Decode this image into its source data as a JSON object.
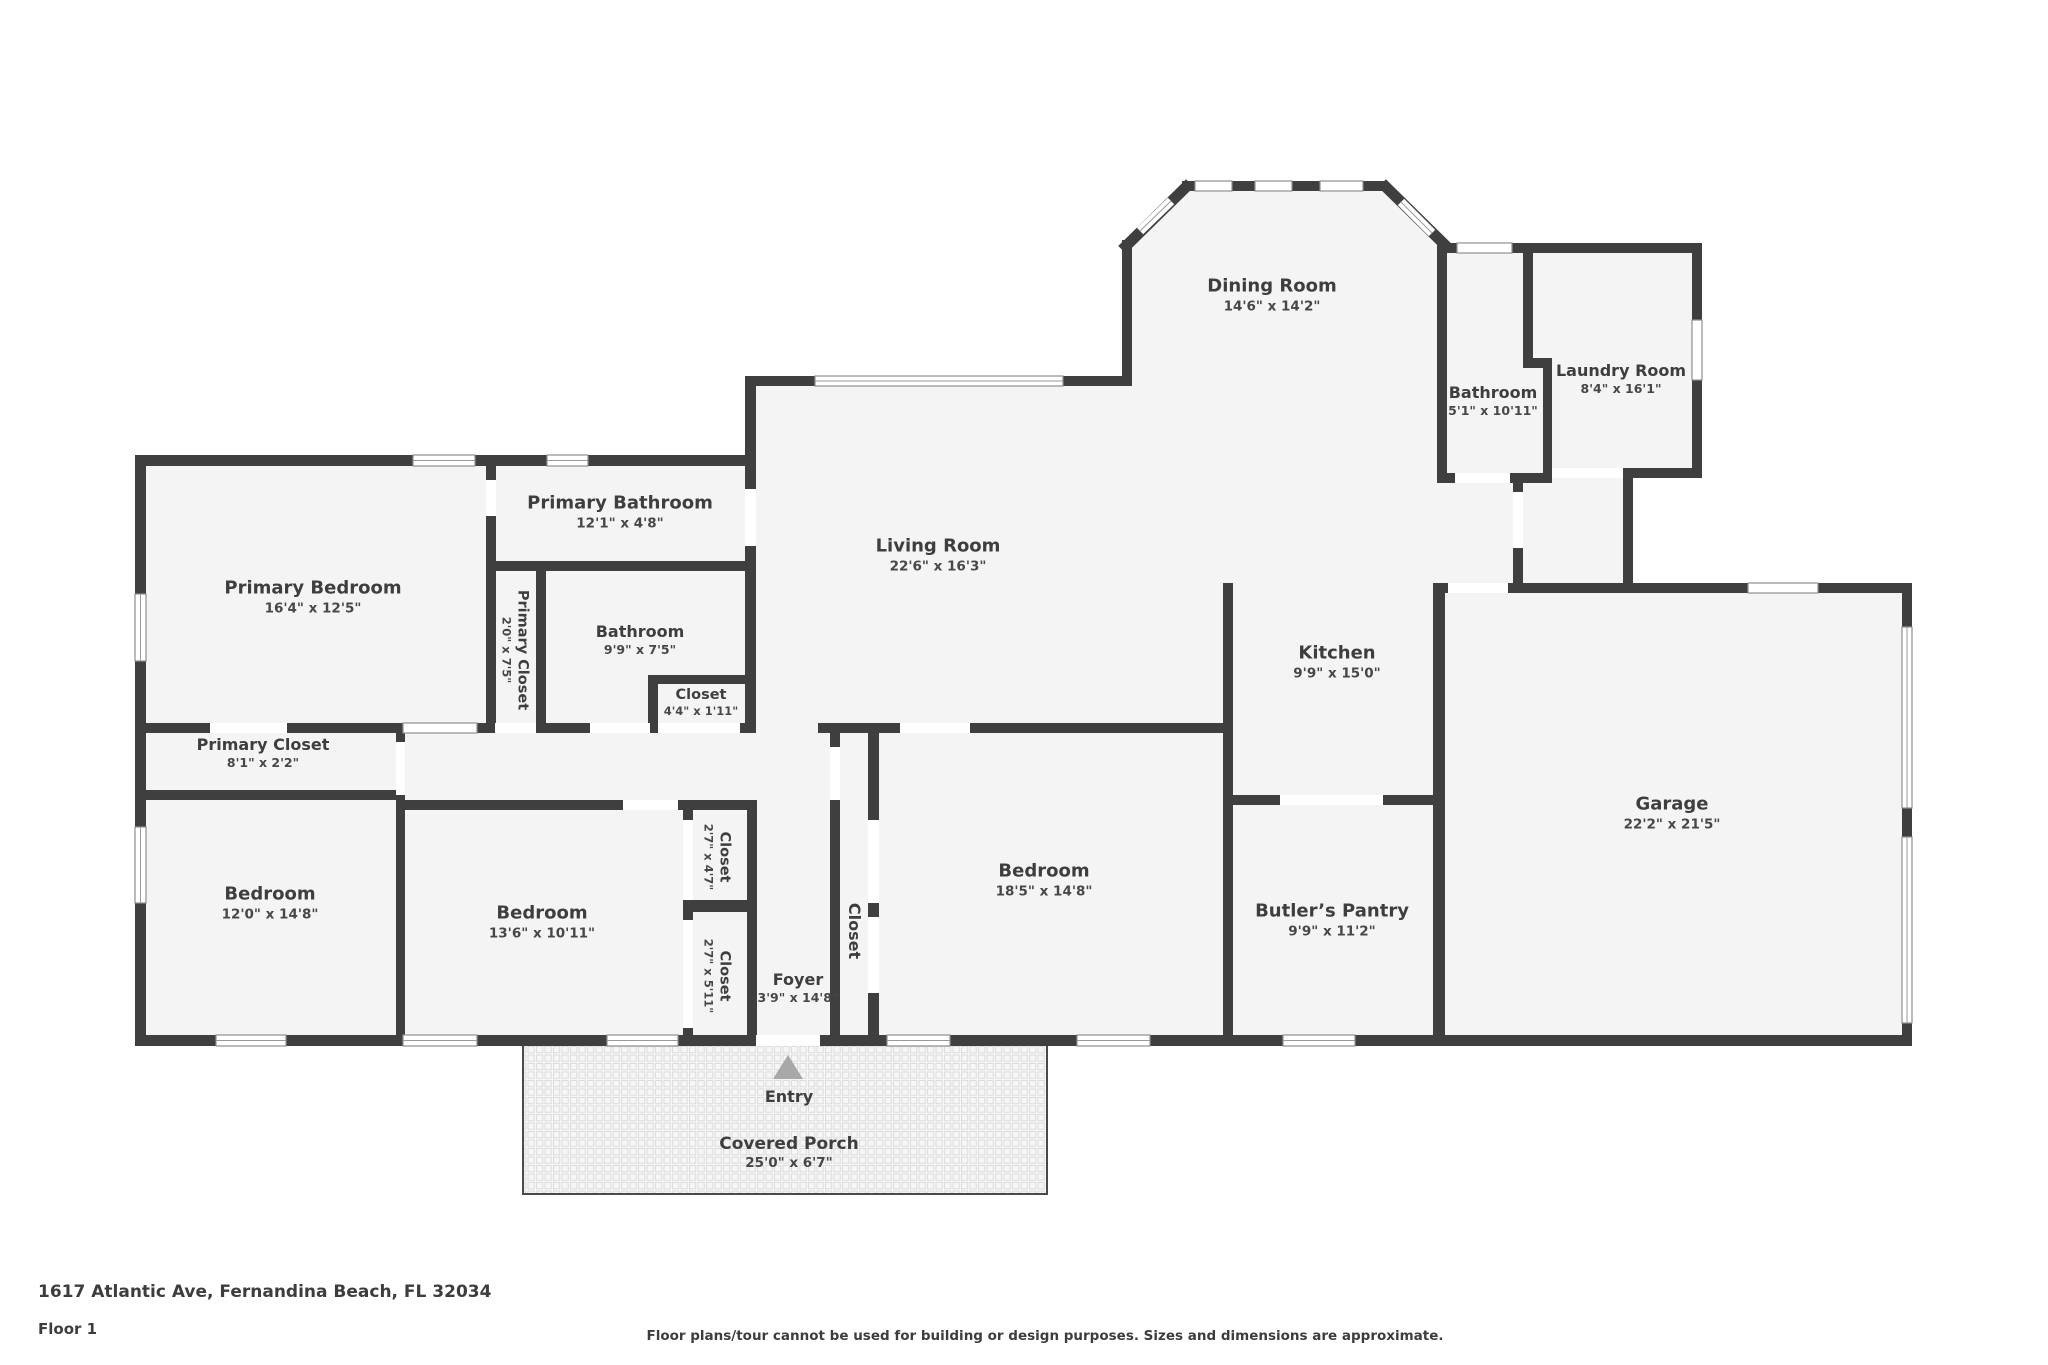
{
  "meta": {
    "address": "1617 Atlantic Ave, Fernandina Beach, FL 32034",
    "floor_label": "Floor 1",
    "disclaimer": "Floor plans/tour cannot be used for building or design purposes. Sizes and dimensions are approximate."
  },
  "colors": {
    "wall": "#3f3f3f",
    "room_fill": "#f4f4f4",
    "window_frame": "#8f8f8f",
    "porch_grid": "#dcdcdc",
    "entry_arrow": "#a8a8a8",
    "text": "#3e3e3e"
  },
  "rooms": {
    "dining": {
      "name": "Dining Room",
      "dims": "14'6\" x 14'2\""
    },
    "living": {
      "name": "Living Room",
      "dims": "22'6\" x 16'3\""
    },
    "kitchen": {
      "name": "Kitchen",
      "dims": "9'9\" x 15'0\""
    },
    "garage": {
      "name": "Garage",
      "dims": "22'2\" x 21'5\""
    },
    "bathroom_top": {
      "name": "Bathroom",
      "dims": "5'1\" x 10'11\""
    },
    "laundry": {
      "name": "Laundry Room",
      "dims": "8'4\" x 16'1\""
    },
    "primary_bedroom": {
      "name": "Primary Bedroom",
      "dims": "16'4\" x 12'5\""
    },
    "primary_bathroom": {
      "name": "Primary Bathroom",
      "dims": "12'1\" x 4'8\""
    },
    "primary_closet_tall": {
      "name": "Primary Closet",
      "dims": "2'0\" x 7'5\""
    },
    "bathroom_mid": {
      "name": "Bathroom",
      "dims": "9'9\" x 7'5\""
    },
    "closet_small": {
      "name": "Closet",
      "dims": "4'4\" x 1'11\""
    },
    "primary_closet_wide": {
      "name": "Primary Closet",
      "dims": "8'1\" x 2'2\""
    },
    "bedroom_left": {
      "name": "Bedroom",
      "dims": "12'0\" x 14'8\""
    },
    "bedroom_mid": {
      "name": "Bedroom",
      "dims": "13'6\" x 10'11\""
    },
    "closet_47": {
      "name": "Closet",
      "dims": "2'7\" x 4'7\""
    },
    "closet_511": {
      "name": "Closet",
      "dims": "2'7\" x 5'11\""
    },
    "foyer": {
      "name": "Foyer",
      "dims": "3'9\" x 14'8\""
    },
    "closet_foyer": {
      "name": "Closet"
    },
    "bedroom_big": {
      "name": "Bedroom",
      "dims": "18'5\" x 14'8\""
    },
    "butlers_pantry": {
      "name": "Butler’s Pantry",
      "dims": "9'9\" x 11'2\""
    },
    "covered_porch": {
      "name": "Covered Porch",
      "dims": "25'0\" x 6'7\""
    },
    "entry": {
      "name": "Entry"
    }
  }
}
